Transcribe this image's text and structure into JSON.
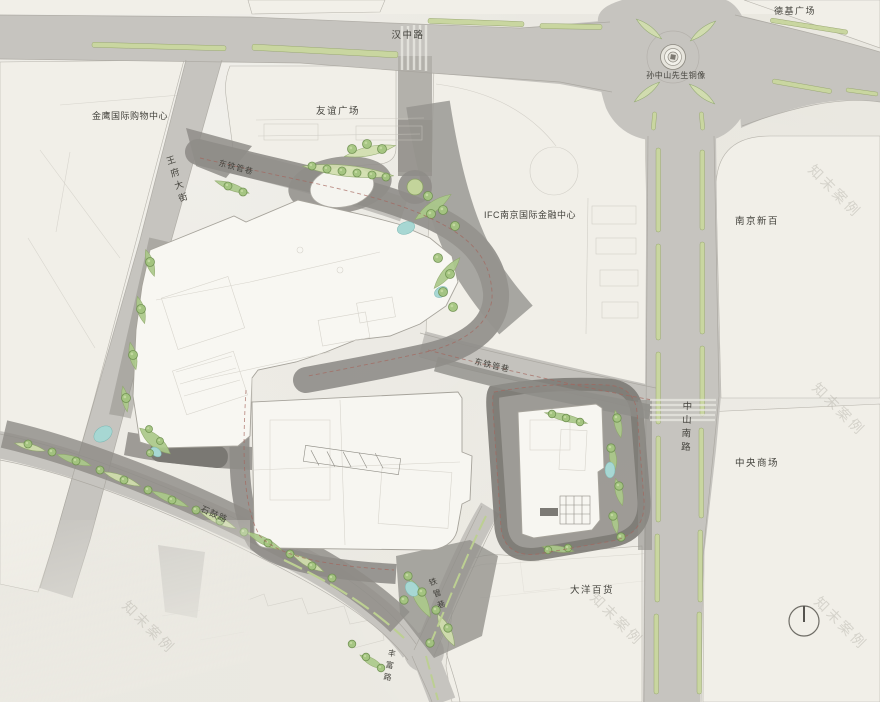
{
  "plan": {
    "watermark": "知末案例",
    "labels": {
      "hanzhong_road": "汉中路",
      "deji_plaza": "德基广场",
      "sun_statue": "孙中山先生铜像",
      "jinying_mall": "金鹰国际购物中心",
      "youyi_plaza": "友谊广场",
      "wangfu_street": "王府大街",
      "dongtie_lane_north": "东铁管巷",
      "ifc_center": "IFC南京国际金融中心",
      "nanjing_xinbai": "南京新百",
      "dongtie_lane_south": "东铁管巷",
      "zhongshan_south_road": "中山南路",
      "zhongyang_mall": "中央商场",
      "shigu_road": "石鼓路",
      "tieguan_lane": "铁管巷",
      "dayang_dept_store": "大洋百货",
      "fengfu_road": "丰富路"
    },
    "colors": {
      "paper": "#ebe9e2",
      "road": "#c6c4bf",
      "plaza_dark": "#8f8d88",
      "green_bed": "#abc98a",
      "tree": "#a3c47f",
      "water": "#a7d7d3",
      "median": "#c9d6a0",
      "label_text": "#45443e"
    }
  }
}
